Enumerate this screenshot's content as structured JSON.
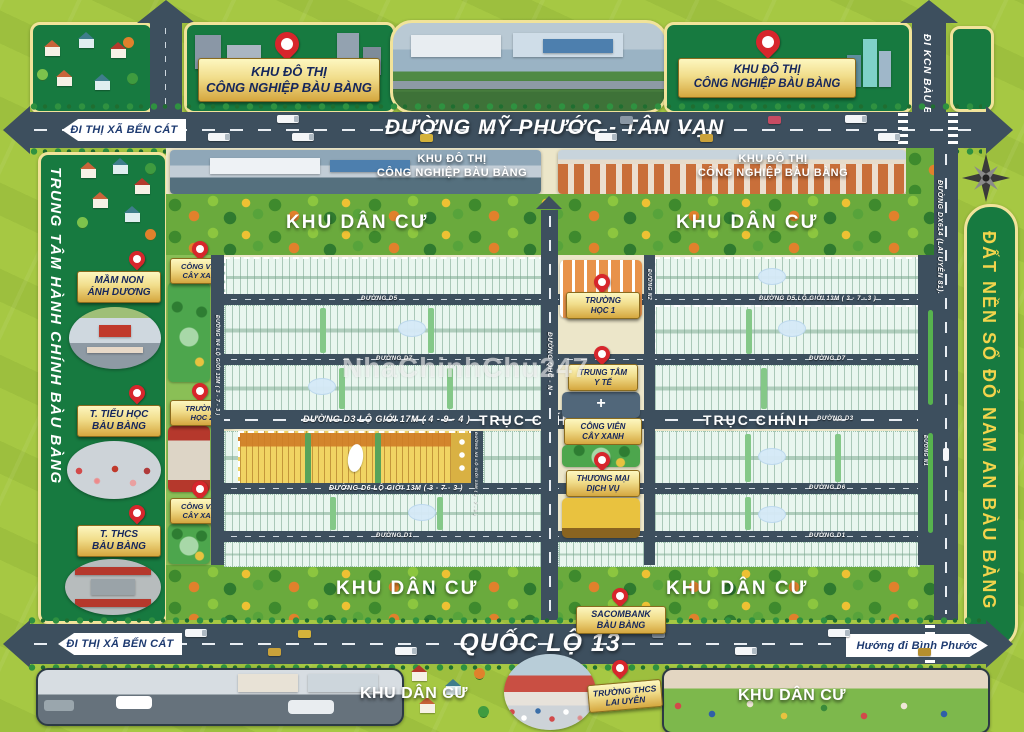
{
  "watermark": "NhaChinhChu247",
  "colors": {
    "panel_green": "#177a40",
    "banner_text_gold": "#f2d44c",
    "road_slate": "#3d4f5e",
    "pin_red": "#d7262c",
    "label_gold": "#e8c96a"
  },
  "top": {
    "industrial_label_line1": "KHU ĐÔ THỊ",
    "industrial_label_line2": "CÔNG NGHIỆP BÀU BÀNG",
    "road_my_phuoc": "ĐƯỜNG MỸ PHƯỚC  -  TÂN VẠN",
    "dir_ben_cat": "ĐI THỊ XÃ BẾN CÁT",
    "dir_kcn_bau_bang": "ĐI KCN BÀU BÀNG"
  },
  "left_panel": {
    "title": "TRUNG TÂM HÀNH CHÍNH BÀU BÀNG",
    "pin1_line1": "MẦM NON",
    "pin1_line2": "ÁNH DƯƠNG",
    "pin2_line1": "T. TIỂU HỌC",
    "pin2_line2": "BÀU BÀNG",
    "pin3_line1": "T. THCS",
    "pin3_line2": "BÀU BÀNG"
  },
  "right_panel": {
    "banner": "ĐẤT NỀN SỔ ĐỎ NAM AN BÀU BÀNG",
    "road_dx614": "ĐƯỜNG DX614 (LAI UYÊN 81)."
  },
  "map": {
    "photo_label_line1": "KHU ĐÔ THỊ",
    "photo_label_line2": "CÔNG NGHIỆP BÀU BÀNG",
    "residential": "KHU DÂN CƯ",
    "park_line1": "CÔNG VIÊN",
    "park_line2": "CÂY XANH",
    "school2_line1": "TRƯỜNG",
    "school2_line2": "HỌC 2",
    "school1_line1": "TRƯỜNG",
    "school1_line2": "HỌC 1",
    "medical_line1": "TRUNG TÂM",
    "medical_line2": "Y TẾ",
    "commerce_line1": "THƯƠNG MẠI",
    "commerce_line2": "DỊCH VỤ",
    "sacombank_line1": "SACOMBANK",
    "sacombank_line2": "BÀU BÀNG",
    "roads": {
      "d5_full": "ĐƯỜNG D5 LỘ GIỚI 13M ( 3 - 7 - 3 )",
      "d5": "ĐƯỜNG D5",
      "d7": "ĐƯỜNG D7",
      "d3_full": "ĐƯỜNG D3 LỘ GIỚI 17M ( 4 - 9 - 4 )",
      "d3": "ĐƯỜNG D3",
      "truc_chinh": "TRỤC CHÍNH",
      "d6_full": "ĐƯỜNG D6 LỘ GIỚI 13M ( 3 - 7 - 3 )",
      "d6": "ĐƯỜNG D6",
      "d1": "ĐƯỜNG D1",
      "n4": "ĐƯỜNG N4 LỘ GIỚI 13M ( 3 - 7 - 3 )",
      "n3": "ĐƯỜNG N3 LỘ GIỚI 13M ( 3 - 7 - 3 )",
      "n2": "ĐƯỜNG N2",
      "n1": "ĐƯỜNG N1",
      "qhc": "ĐƯỜNG QHC - N"
    }
  },
  "bottom": {
    "road_ql13": "QUỐC LỘ 13",
    "dir_ben_cat": "ĐI THỊ XÃ BẾN CÁT",
    "dir_binh_phuoc": "Hướng đi Bình Phước",
    "residential": "KHU DÂN CƯ",
    "school_line1": "TRƯỜNG THCS",
    "school_line2": "LAI UYÊN"
  }
}
